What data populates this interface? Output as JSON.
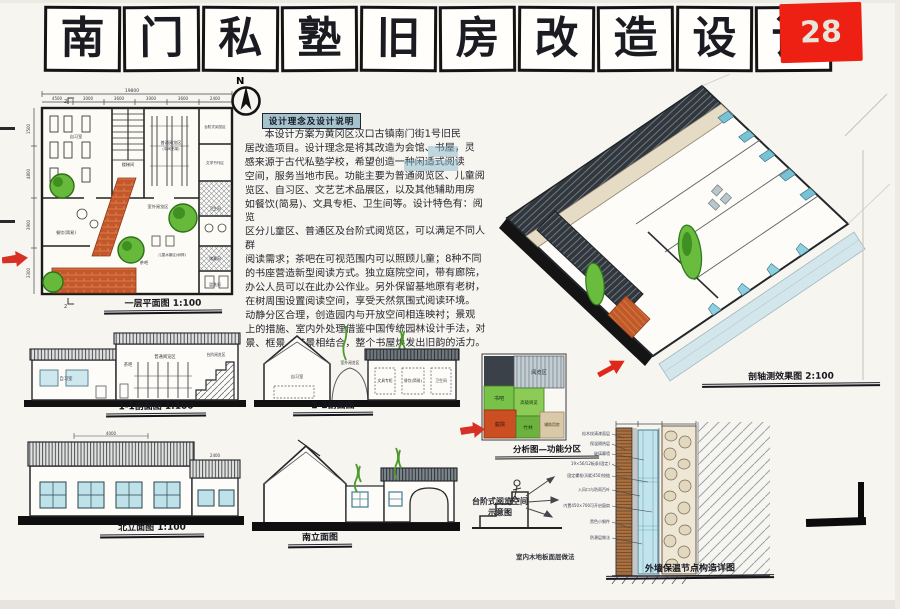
{
  "sheet": {
    "number": "28",
    "title_chars": [
      "南",
      "门",
      "私",
      "塾",
      "旧",
      "房",
      "改",
      "造",
      "设",
      "计"
    ],
    "north_label": "N"
  },
  "colors": {
    "accent_red": "#ee2014",
    "window_blue": "#bfe2ea",
    "tree_green": "#67b93c",
    "brick_orange": "#c4582a",
    "roof_dark": "#343a40",
    "highlight_blue": "#a7c2cc"
  },
  "notes": {
    "header": "设计理念及设计说明",
    "body": "　　本设计方案为黄冈区汉口古镇南门街1号旧民\n居改造项目。设计理念是将其改造为会馆、书屋，灵\n感来源于古代私塾学校，希望创造一种闲适式阅读\n空间，服务当地市民。功能主要为普通阅览区、儿童阅\n览区、自习区、文艺艺术品展区，以及其他辅助用房\n如餐饮(简易)、文具专柜、卫生间等。设计特色有：阅览\n区分儿童区、普通区及台阶式阅览区，可以满足不同人群\n阅读需求；茶吧在可视范围内可以照顾儿童；8种不同\n的书座营造新型阅读方式。独立庭院空间，带有廊院，\n办公人员可以在此办公作业。另外保留基地原有老树，\n在树周围设置阅读空间，享受天然氛围式阅读环境。\n动静分区合理，创造园内与开放空间相连映衬；景观\n上的措施、室内外处理借鉴中国传统园林设计手法，对\n景、框景、借景相结合，整个书屋焕发出旧韵的活力。"
  },
  "plan": {
    "label": "一层平面图 1:100",
    "overall_dim": "19800",
    "dims_top": [
      "4500",
      "3000",
      "3600",
      "3000",
      "3600",
      "2400"
    ],
    "dims_left": [
      "1500",
      "4800",
      "3900",
      "3300"
    ],
    "marker": "2",
    "rooms": [
      "自习室",
      "楼梯间",
      "普通阅览区",
      "(中间书架)",
      "台阶式阅览区",
      "文学书刊区",
      "餐饮(简易)",
      "茶吧",
      "室外阅览区",
      "儿童水景区(树阵)",
      "卫生间",
      "储藏间",
      "盥洗间"
    ]
  },
  "sections": {
    "s11": {
      "label": "1-1剖面图 1:100",
      "rooms": [
        "自习室",
        "茶吧",
        "普通阅览区",
        "台阶阅览区"
      ]
    },
    "s22": {
      "label": "2-2剖面图",
      "rooms": [
        "自习室",
        "室外阅览区",
        "文具专柜",
        "餐饮(简易)",
        "卫生间"
      ]
    }
  },
  "elevations": {
    "north": {
      "label": "北立面图 1:100",
      "dims": [
        "4000",
        "2400"
      ]
    },
    "south": {
      "label": "南立面图"
    }
  },
  "axon": {
    "label": "剖轴测效果图 2:100"
  },
  "zoning": {
    "label": "分析图—功能分区",
    "blocks": [
      "阅览区",
      "书吧",
      "高级阅览",
      "庭院",
      "竹林",
      "辅助用房"
    ]
  },
  "steps_sketch": {
    "label_line1": "台阶式阅览空间",
    "label_line2": "示意图"
  },
  "wall_detail": {
    "label": "外墙保温节点构造详图",
    "side_note": "室内木地板面层做法",
    "annotations": [
      "松木纹清漆面层",
      "保温隔热层",
      "玻璃幕墙",
      "19×56/12板条(固定)",
      "固定螺栓(间距450)铰链",
      "入风口与防雨百叶",
      "内置450×700可开启窗扇",
      "黑色小钢件",
      "防潮层做法"
    ]
  }
}
